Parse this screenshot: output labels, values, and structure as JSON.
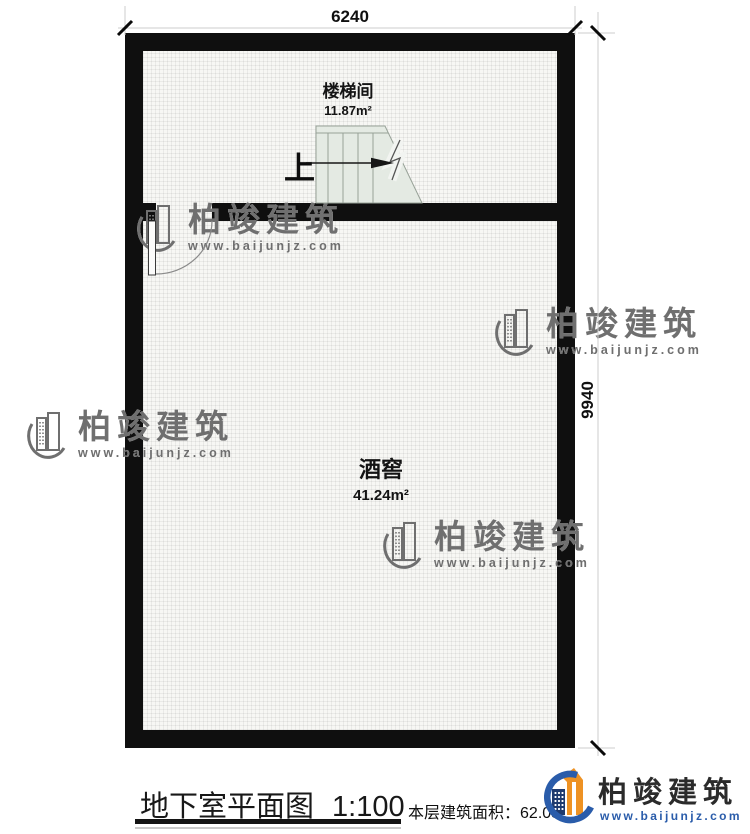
{
  "plan": {
    "dim_width": "6240",
    "dim_height": "9940",
    "stairwell": {
      "name": "楼梯间",
      "area": "11.87m²"
    },
    "wine_cellar": {
      "name": "酒窖",
      "area": "41.24m²"
    },
    "stair_direction": "上"
  },
  "watermark": {
    "brand": "柏竣建筑",
    "url": "www.baijunjz.com"
  },
  "title_block": {
    "title": "地下室平面图",
    "scale": "1:100",
    "area_label": "本层建筑面积：",
    "area_value": "62.03"
  },
  "logo": {
    "brand": "柏竣建筑",
    "url": "www.baijunjz.com"
  },
  "colors": {
    "wall": "#0f0f0f",
    "stair_fill": "#e4eae3",
    "stair_stroke": "#97a197",
    "logo_orange": "#ee9223",
    "logo_blue": "#2a5caa",
    "logo_navy": "#1e3a6e"
  }
}
